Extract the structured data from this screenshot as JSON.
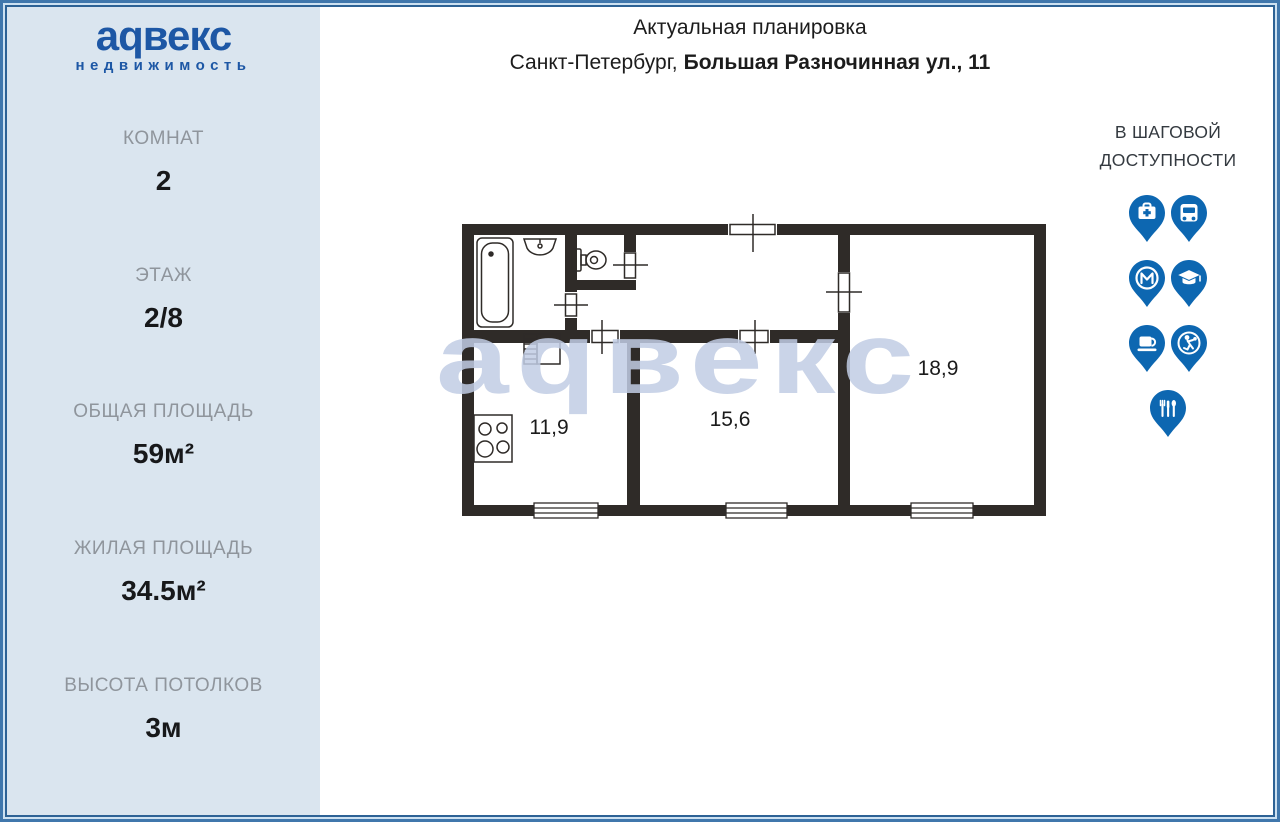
{
  "logo": {
    "brand": "аqвекс",
    "subtitle": "недвижимость"
  },
  "sidebar": {
    "stats": [
      {
        "label": "КОМНАТ",
        "value": "2"
      },
      {
        "label": "ЭТАЖ",
        "value": "2/8"
      },
      {
        "label": "ОБЩАЯ ПЛОЩАДЬ",
        "value": "59м²"
      },
      {
        "label": "ЖИЛАЯ ПЛОЩАДЬ",
        "value": "34.5м²"
      },
      {
        "label": "ВЫСОТА ПОТОЛКОВ",
        "value": "3м"
      }
    ]
  },
  "header": {
    "title": "Актуальная планировка",
    "city": "Санкт-Петербург,",
    "address": "Большая Разночинная ул., 11"
  },
  "floor_plan": {
    "watermark": "аqвекс",
    "rooms": [
      {
        "name": "kitchen",
        "area": "11,9"
      },
      {
        "name": "room-middle",
        "area": "15,6"
      },
      {
        "name": "room-right",
        "area": "18,9"
      }
    ]
  },
  "poi": {
    "line1": "В ШАГОВОЙ",
    "line2": "ДОСТУПНОСТИ",
    "items": [
      "hospital",
      "bus",
      "metro",
      "education",
      "cafe",
      "sport",
      "restaurant"
    ]
  },
  "colors": {
    "pin_blue": "#0d67b1",
    "logo_blue": "#1d57a5",
    "sidebar_bg": "#dae5ef",
    "wall": "#2f2b28",
    "watermark": "#c1cce4"
  }
}
